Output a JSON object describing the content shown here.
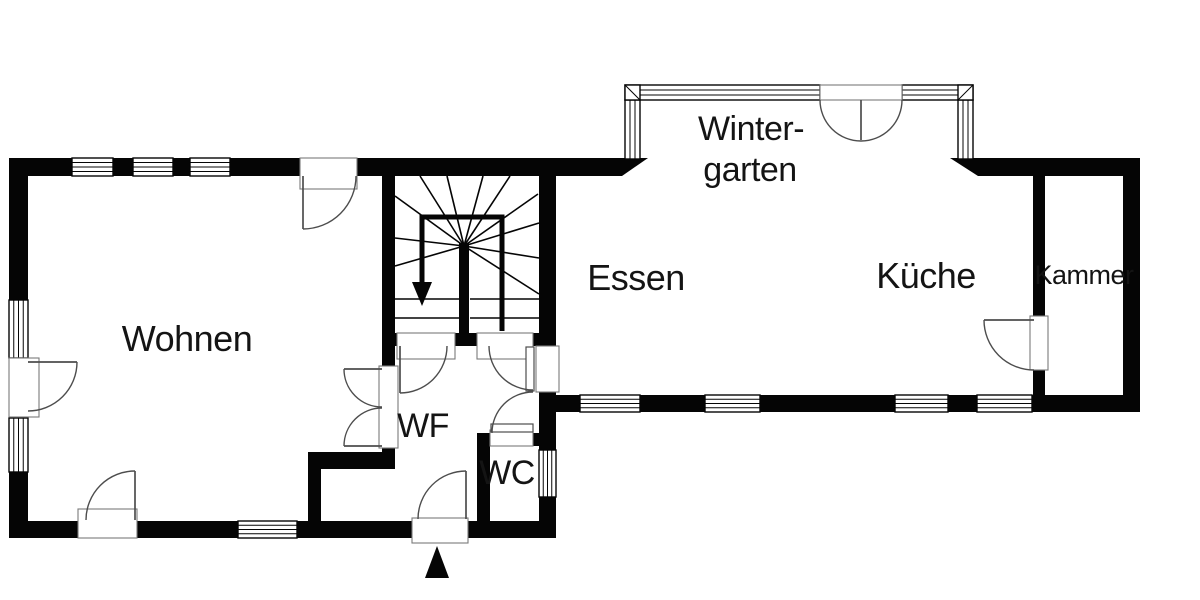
{
  "colors": {
    "wall-color": "#050505",
    "bg-color": "#ffffff",
    "door-color": "#4d4d4d",
    "frame-color": "#7a7a7a",
    "text-color": "#141414"
  },
  "rooms": {
    "wohnen": {
      "label": "Wohnen"
    },
    "essen": {
      "label": "Essen"
    },
    "kueche": {
      "label": "Küche"
    },
    "kammer": {
      "label": "Kammer"
    },
    "wf": {
      "label": "WF"
    },
    "wc": {
      "label": "WC"
    },
    "wintergarten": {
      "line1": "Winter-",
      "line2": "garten"
    }
  }
}
